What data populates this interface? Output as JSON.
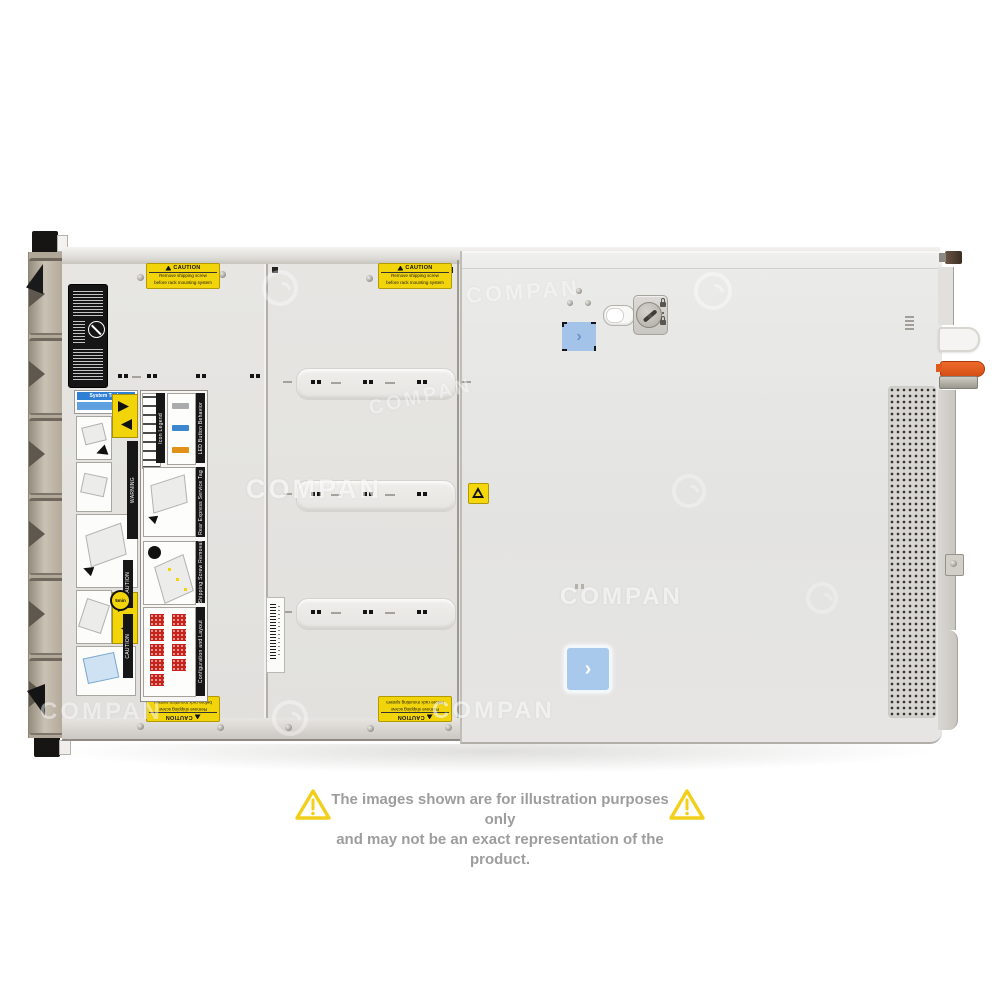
{
  "product": {
    "type": "rack-server-top-view"
  },
  "watermark": {
    "text": "COMPAN"
  },
  "disclaimer": {
    "line1": "The images shown are for illustration purposes only",
    "line2": "and may not be an exact representation of the product."
  },
  "caution_sticker": {
    "title": "CAUTION",
    "line1": "Remove shipping screw",
    "line2": "before rack mounting system"
  },
  "labels": {
    "system_tasks": "System Tasks",
    "warning_bar": "WARNING",
    "caution_bar": "CAUTION",
    "five_min": "5min",
    "sections": [
      {
        "title": "Icon Legend"
      },
      {
        "title": "LED Button Behavior"
      },
      {
        "title": "Rear Express Service Tag"
      },
      {
        "title": "Shipping Screw Removal"
      },
      {
        "title": "Configuration and Layout"
      }
    ]
  },
  "icons": {
    "chevron": "›",
    "warning_exclaim": "!"
  },
  "colors": {
    "caution_yellow": "#f2d40a",
    "sticker_blue": "#a6c6ea",
    "latch_orange": "#e0581e",
    "drive_bay_red": "#c5231b"
  }
}
